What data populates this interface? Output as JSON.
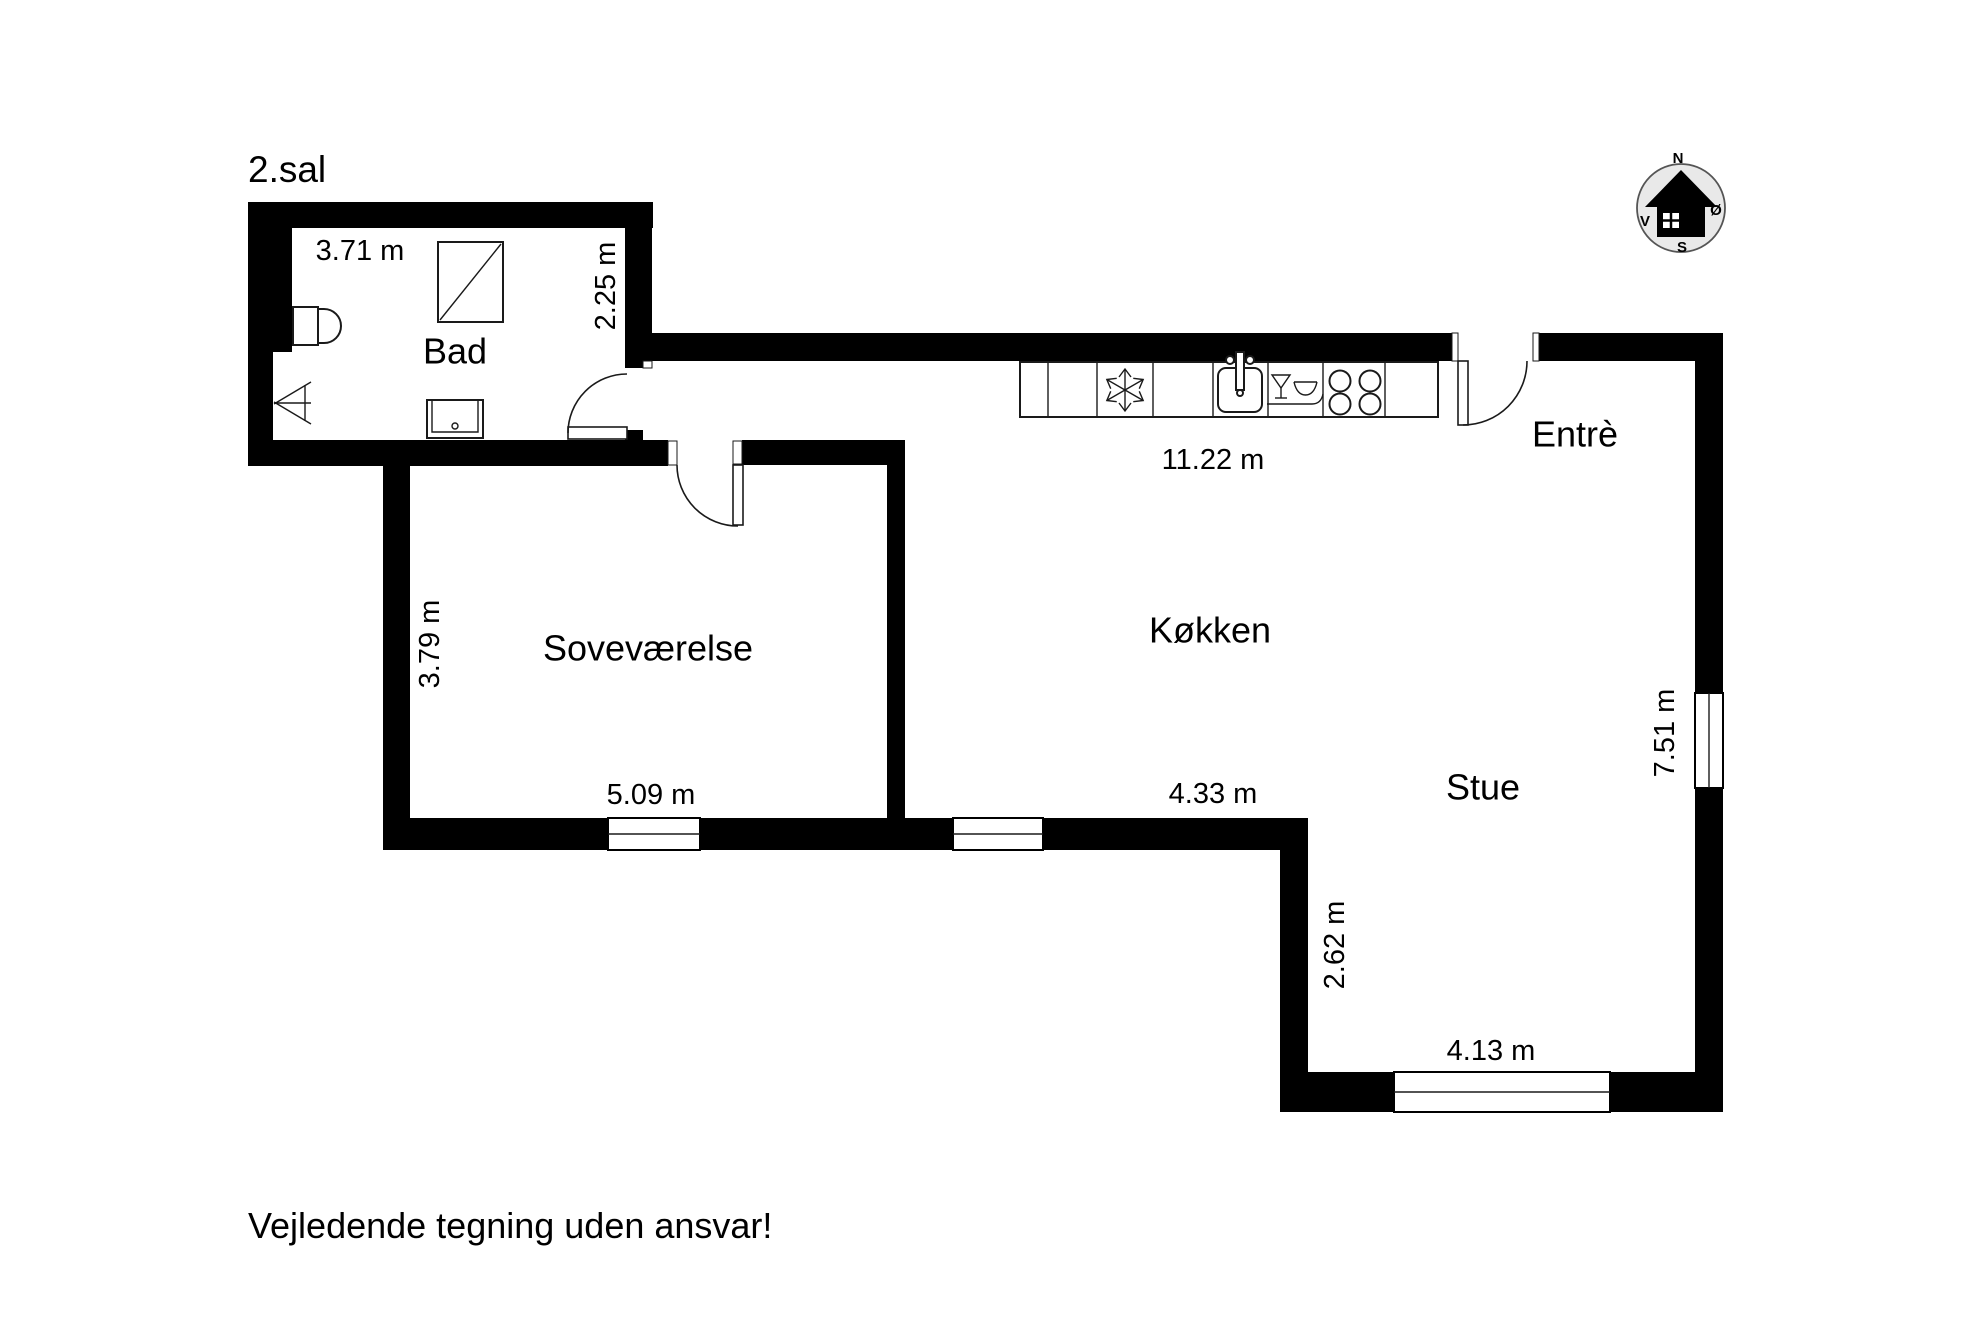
{
  "floor_plan": {
    "title": "2.sal",
    "disclaimer": "Vejledende tegning uden ansvar!",
    "wall_color": "#000000",
    "background_color": "#ffffff",
    "rooms": {
      "bad": "Bad",
      "sovevaerelse": "Soveværelse",
      "koekken": "Køkken",
      "stue": "Stue",
      "entre": "Entrè"
    },
    "dimensions": {
      "bad_width": "3.71 m",
      "bad_depth": "2.25 m",
      "koekken_width": "11.22 m",
      "sovevaerelse_depth": "3.79 m",
      "sovevaerelse_width": "5.09 m",
      "koekken_south": "4.33 m",
      "stue_depth": "7.51 m",
      "stue_step": "2.62 m",
      "stue_width": "4.13 m"
    },
    "compass": {
      "north": "N",
      "east": "Ø",
      "south": "S",
      "west": "V",
      "circle_fill": "#e9e9e9",
      "house_fill": "#000000"
    },
    "fixtures": [
      "shower",
      "toilet",
      "hand-basin",
      "washbasin",
      "kitchen-counter",
      "freezer-snowflake",
      "kitchen-sink",
      "dishwasher",
      "stove-4-burner"
    ]
  }
}
